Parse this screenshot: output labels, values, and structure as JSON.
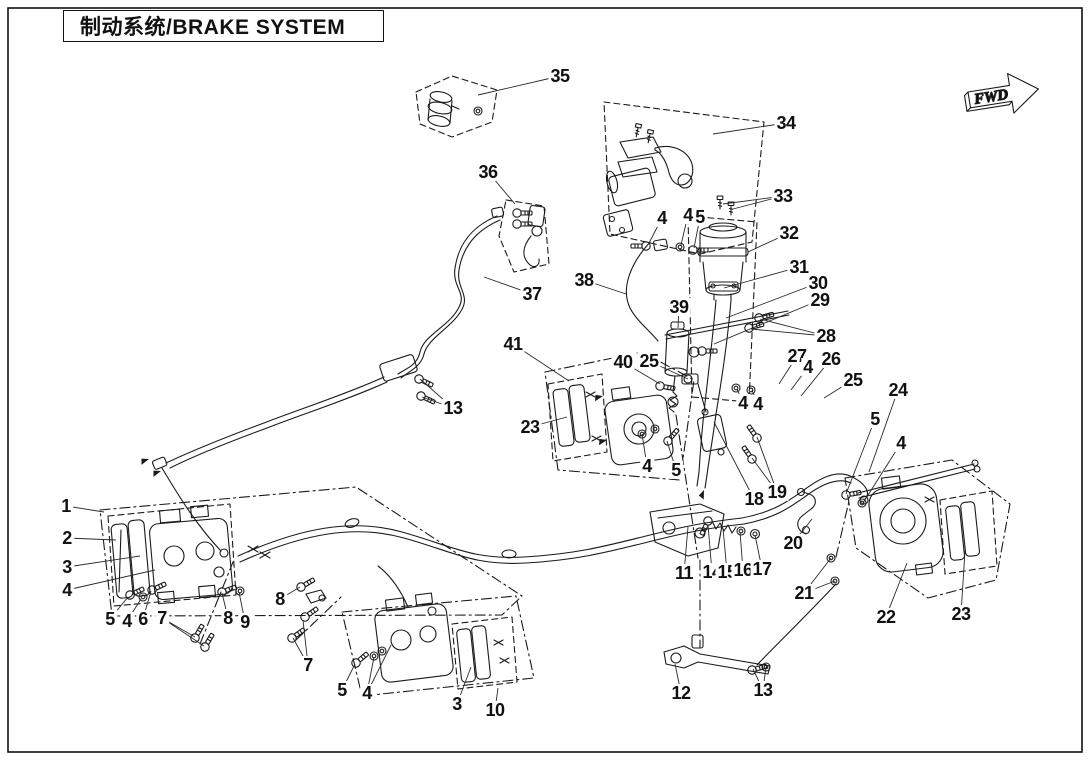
{
  "page": {
    "title": "制动系统/BRAKE SYSTEM",
    "fwd_label": "FWD"
  },
  "callouts": [
    {
      "n": "1",
      "x": 66,
      "y": 506,
      "t": [
        [
          104,
          512
        ]
      ]
    },
    {
      "n": "2",
      "x": 67,
      "y": 538,
      "t": [
        [
          116,
          540
        ]
      ]
    },
    {
      "n": "3",
      "x": 67,
      "y": 567,
      "t": [
        [
          140,
          556
        ]
      ]
    },
    {
      "n": "4",
      "x": 67,
      "y": 590,
      "t": [
        [
          155,
          570
        ]
      ]
    },
    {
      "n": "5",
      "x": 110,
      "y": 619,
      "t": [
        [
          128,
          597
        ]
      ]
    },
    {
      "n": "4",
      "x": 127,
      "y": 621,
      "t": [
        [
          141,
          599
        ]
      ]
    },
    {
      "n": "6",
      "x": 143,
      "y": 619,
      "t": [
        [
          151,
          591
        ]
      ]
    },
    {
      "n": "7",
      "x": 162,
      "y": 618,
      "t": [
        [
          195,
          637
        ],
        [
          204,
          646
        ]
      ]
    },
    {
      "n": "8",
      "x": 228,
      "y": 618,
      "t": [
        [
          222,
          593
        ]
      ]
    },
    {
      "n": "9",
      "x": 245,
      "y": 622,
      "t": [
        [
          239,
          592
        ]
      ]
    },
    {
      "n": "8",
      "x": 280,
      "y": 599,
      "t": [
        [
          300,
          587
        ]
      ]
    },
    {
      "n": "7",
      "x": 308,
      "y": 665,
      "t": [
        [
          303,
          620
        ],
        [
          293,
          638
        ]
      ]
    },
    {
      "n": "5",
      "x": 342,
      "y": 690,
      "t": [
        [
          355,
          664
        ]
      ]
    },
    {
      "n": "4",
      "x": 367,
      "y": 693,
      "t": [
        [
          374,
          657
        ],
        [
          391,
          645
        ]
      ]
    },
    {
      "n": "3",
      "x": 457,
      "y": 704,
      "t": [
        [
          471,
          667
        ]
      ]
    },
    {
      "n": "10",
      "x": 495,
      "y": 710,
      "t": [
        [
          498,
          688
        ]
      ]
    },
    {
      "n": "13",
      "x": 453,
      "y": 408,
      "t": [
        [
          420,
          379
        ],
        [
          422,
          397
        ]
      ]
    },
    {
      "n": "35",
      "x": 560,
      "y": 76,
      "t": [
        [
          478,
          95
        ]
      ]
    },
    {
      "n": "36",
      "x": 488,
      "y": 172,
      "t": [
        [
          515,
          204
        ]
      ]
    },
    {
      "n": "37",
      "x": 532,
      "y": 294,
      "t": [
        [
          484,
          277
        ]
      ]
    },
    {
      "n": "38",
      "x": 584,
      "y": 280,
      "t": [
        [
          626,
          294
        ]
      ]
    },
    {
      "n": "34",
      "x": 786,
      "y": 123,
      "t": [
        [
          713,
          134
        ]
      ]
    },
    {
      "n": "33",
      "x": 783,
      "y": 196,
      "t": [
        [
          723,
          204
        ],
        [
          733,
          209
        ]
      ]
    },
    {
      "n": "32",
      "x": 789,
      "y": 233,
      "t": [
        [
          748,
          252
        ]
      ]
    },
    {
      "n": "31",
      "x": 799,
      "y": 267,
      "t": [
        [
          724,
          288
        ]
      ]
    },
    {
      "n": "30",
      "x": 818,
      "y": 283,
      "t": [
        [
          726,
          318
        ]
      ]
    },
    {
      "n": "29",
      "x": 820,
      "y": 300,
      "t": [
        [
          714,
          344
        ]
      ]
    },
    {
      "n": "28",
      "x": 826,
      "y": 336,
      "t": [
        [
          760,
          319
        ],
        [
          751,
          329
        ]
      ]
    },
    {
      "n": "4",
      "x": 662,
      "y": 218,
      "t": [
        [
          649,
          243
        ]
      ]
    },
    {
      "n": "4",
      "x": 688,
      "y": 215,
      "t": [
        [
          681,
          245
        ]
      ]
    },
    {
      "n": "5",
      "x": 700,
      "y": 217,
      "t": [
        [
          694,
          248
        ]
      ]
    },
    {
      "n": "39",
      "x": 679,
      "y": 307,
      "t": [
        [
          678,
          328
        ]
      ]
    },
    {
      "n": "40",
      "x": 623,
      "y": 362,
      "t": [
        [
          660,
          384
        ]
      ]
    },
    {
      "n": "25",
      "x": 649,
      "y": 361,
      "t": [
        [
          688,
          379
        ]
      ]
    },
    {
      "n": "41",
      "x": 513,
      "y": 344,
      "t": [
        [
          569,
          381
        ]
      ]
    },
    {
      "n": "23",
      "x": 530,
      "y": 427,
      "t": [
        [
          567,
          417
        ]
      ]
    },
    {
      "n": "27",
      "x": 797,
      "y": 356,
      "t": [
        [
          779,
          384
        ]
      ]
    },
    {
      "n": "4",
      "x": 808,
      "y": 367,
      "t": [
        [
          791,
          390
        ]
      ]
    },
    {
      "n": "26",
      "x": 831,
      "y": 359,
      "t": [
        [
          801,
          396
        ]
      ]
    },
    {
      "n": "25",
      "x": 853,
      "y": 380,
      "t": [
        [
          824,
          398
        ]
      ]
    },
    {
      "n": "24",
      "x": 898,
      "y": 390,
      "t": [
        [
          869,
          472
        ]
      ]
    },
    {
      "n": "5",
      "x": 875,
      "y": 419,
      "t": [
        [
          846,
          494
        ]
      ]
    },
    {
      "n": "4",
      "x": 901,
      "y": 443,
      "t": [
        [
          863,
          503
        ]
      ]
    },
    {
      "n": "4",
      "x": 743,
      "y": 403,
      "t": [
        [
          737,
          389
        ]
      ]
    },
    {
      "n": "4",
      "x": 758,
      "y": 404,
      "t": [
        [
          752,
          390
        ]
      ]
    },
    {
      "n": "4",
      "x": 647,
      "y": 466,
      "t": [
        [
          642,
          434
        ]
      ]
    },
    {
      "n": "5",
      "x": 676,
      "y": 470,
      "t": [
        [
          667,
          441
        ]
      ]
    },
    {
      "n": "18",
      "x": 754,
      "y": 499,
      "t": [
        [
          714,
          422
        ]
      ]
    },
    {
      "n": "19",
      "x": 777,
      "y": 492,
      "t": [
        [
          757,
          437
        ],
        [
          752,
          458
        ]
      ]
    },
    {
      "n": "20",
      "x": 793,
      "y": 543,
      "t": [
        [
          812,
          519
        ]
      ]
    },
    {
      "n": "21",
      "x": 804,
      "y": 593,
      "t": [
        [
          831,
          558
        ],
        [
          835,
          581
        ]
      ]
    },
    {
      "n": "11",
      "x": 684,
      "y": 573,
      "t": [
        [
          688,
          527
        ]
      ]
    },
    {
      "n": "14",
      "x": 712,
      "y": 572,
      "t": [
        [
          708,
          525
        ]
      ]
    },
    {
      "n": "15",
      "x": 727,
      "y": 572,
      "t": [
        [
          723,
          528
        ]
      ]
    },
    {
      "n": "16",
      "x": 743,
      "y": 570,
      "t": [
        [
          740,
          532
        ]
      ]
    },
    {
      "n": "17",
      "x": 762,
      "y": 569,
      "t": [
        [
          755,
          535
        ]
      ]
    },
    {
      "n": "12",
      "x": 681,
      "y": 693,
      "t": [
        [
          675,
          664
        ]
      ]
    },
    {
      "n": "13",
      "x": 763,
      "y": 690,
      "t": [
        [
          753,
          669
        ],
        [
          766,
          667
        ]
      ]
    },
    {
      "n": "22",
      "x": 886,
      "y": 617,
      "t": [
        [
          907,
          563
        ]
      ]
    },
    {
      "n": "23",
      "x": 961,
      "y": 614,
      "t": [
        [
          965,
          551
        ]
      ]
    }
  ]
}
